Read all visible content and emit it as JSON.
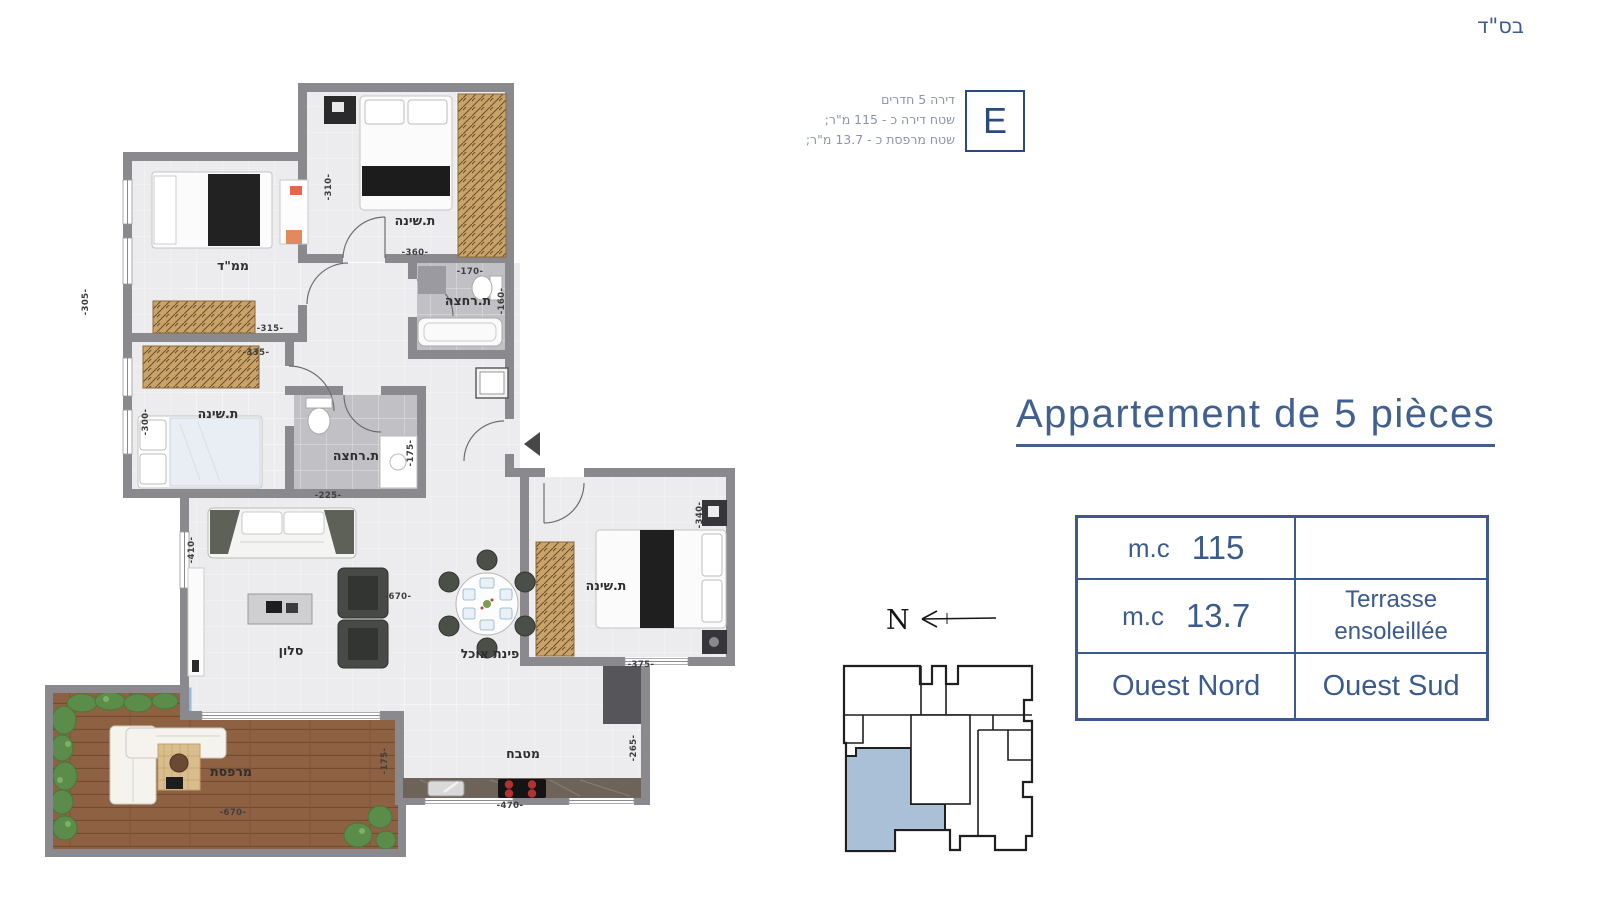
{
  "header": {
    "bsd": "בס\"ד"
  },
  "unit_info": {
    "letter": "E",
    "line1": "דירה 5 חדרים",
    "line2": "שטח דירה כ - 115 מ\"ר;",
    "line3": "שטח מרפסת כ - 13.7 מ\"ר;"
  },
  "title": "Appartement de 5 pièces",
  "surface_table": {
    "row1": {
      "unit": "m.c",
      "value": "115",
      "right": ""
    },
    "row2": {
      "unit": "m.c",
      "value": "13.7",
      "right_line1": "Terrasse",
      "right_line2": "ensoleillée"
    },
    "row3": {
      "left": "Ouest Nord",
      "right": "Ouest Sud"
    }
  },
  "compass": {
    "north_label": "N"
  },
  "floorplan": {
    "rooms": [
      {
        "label": "ת.שינה",
        "x": 375,
        "y": 145
      },
      {
        "label": "ממ\"ד",
        "x": 193,
        "y": 190
      },
      {
        "label": "ת.רחצה",
        "x": 428,
        "y": 225
      },
      {
        "label": "ת.שינה",
        "x": 178,
        "y": 338
      },
      {
        "label": "ת.רחצה",
        "x": 316,
        "y": 380
      },
      {
        "label": "סלון",
        "x": 251,
        "y": 575
      },
      {
        "label": "פינת אוכל",
        "x": 450,
        "y": 578
      },
      {
        "label": "ת.שינה",
        "x": 566,
        "y": 510
      },
      {
        "label": "מטבח",
        "x": 483,
        "y": 678
      },
      {
        "label": "מרפסת",
        "x": 191,
        "y": 696
      }
    ],
    "dimensions": [
      {
        "value": "-305-",
        "x": 48,
        "y": 222,
        "rot": -90
      },
      {
        "value": "-310-",
        "x": 291,
        "y": 107,
        "rot": -90
      },
      {
        "value": "-360-",
        "x": 375,
        "y": 175,
        "rot": 0
      },
      {
        "value": "-315-",
        "x": 230,
        "y": 251,
        "rot": 0
      },
      {
        "value": "-170-",
        "x": 430,
        "y": 194,
        "rot": 0
      },
      {
        "value": "-160-",
        "x": 464,
        "y": 221,
        "rot": -90
      },
      {
        "value": "-335-",
        "x": 216,
        "y": 275,
        "rot": 0
      },
      {
        "value": "-300-",
        "x": 108,
        "y": 342,
        "rot": -90
      },
      {
        "value": "-225-",
        "x": 288,
        "y": 418,
        "rot": 0
      },
      {
        "value": "-175-",
        "x": 373,
        "y": 373,
        "rot": -90
      },
      {
        "value": "-410-",
        "x": 154,
        "y": 470,
        "rot": -90
      },
      {
        "value": "-670-",
        "x": 358,
        "y": 519,
        "rot": 0
      },
      {
        "value": "-340-",
        "x": 662,
        "y": 435,
        "rot": -90
      },
      {
        "value": "-375-",
        "x": 601,
        "y": 587,
        "rot": 0
      },
      {
        "value": "-265-",
        "x": 596,
        "y": 668,
        "rot": -90
      },
      {
        "value": "-470-",
        "x": 470,
        "y": 728,
        "rot": 0
      },
      {
        "value": "-670-",
        "x": 193,
        "y": 735,
        "rot": 0
      },
      {
        "value": "-175-",
        "x": 347,
        "y": 681,
        "rot": -90
      }
    ]
  },
  "site_plan": {
    "highlight_color": "#a9c0d6"
  },
  "colors": {
    "accent_navy": "#3b5a8e",
    "info_gray": "#8c95a5",
    "wall_gray": "#8a898e",
    "floor_light": "#ececee",
    "bath_floor": "#c0c0c5",
    "deck_wood": "#8d6142",
    "closet_wood": "#c9a368",
    "plant_green": "#5c8c4a",
    "railing_blue": "#8fbbdc",
    "highlight_unit": "#a9c0d6"
  }
}
